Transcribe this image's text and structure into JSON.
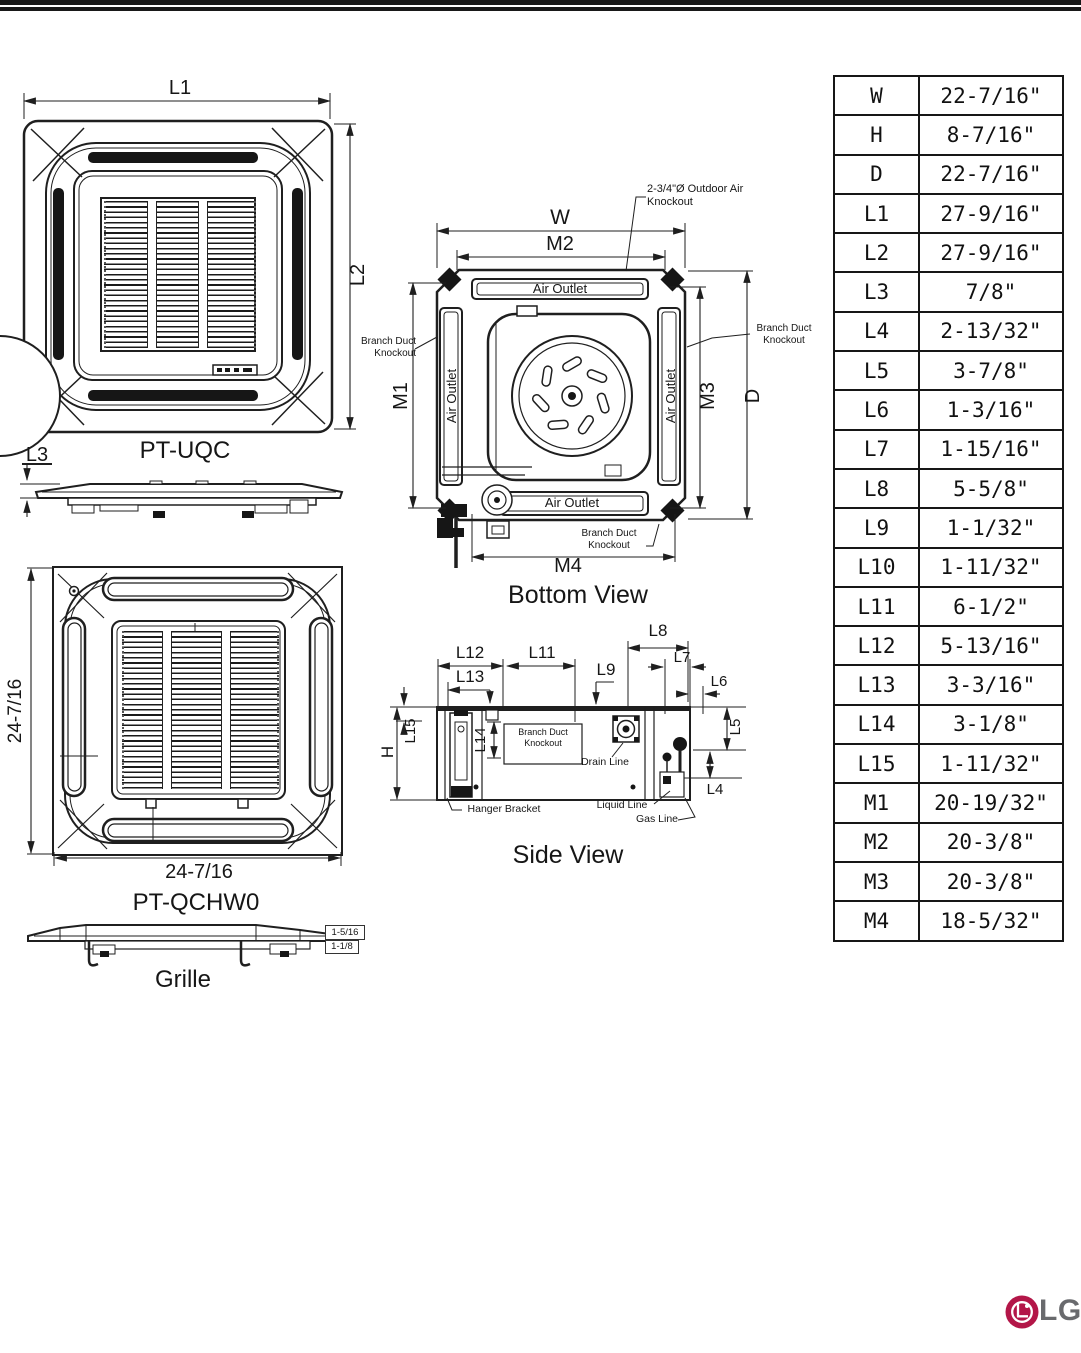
{
  "views": {
    "top": {
      "caption": "PT-UQC",
      "l1": "L1",
      "l2": "L2",
      "l3": "L3"
    },
    "bottom": {
      "title": "Bottom View",
      "w": "W",
      "m1": "M1",
      "m2": "M2",
      "m3": "M3",
      "m4": "M4",
      "d": "D",
      "air_outlet": "Air Outlet",
      "branch_duct_knockout": "Branch Duct Knockout",
      "outdoor_air_knockout": "2-3/4\"Ø Outdoor Air Knockout"
    },
    "side": {
      "title": "Side View",
      "h": "H",
      "l4": "L4",
      "l5": "L5",
      "l6": "L6",
      "l7": "L7",
      "l8": "L8",
      "l9": "L9",
      "l11": "L11",
      "l12": "L12",
      "l13": "L13",
      "l14": "L14",
      "l15": "L15",
      "branch_duct_knockout": "Branch Duct Knockout",
      "drain_line": "Drain Line",
      "hanger_bracket": "Hanger Bracket",
      "liquid_line": "Liquid Line",
      "gas_line": "Gas Line"
    },
    "grille": {
      "caption": "PT-QCHW0",
      "label": "Grille",
      "width_dim": "24-7/16",
      "height_dim": "24-7/16",
      "profile_top_dim": "1-5/16",
      "profile_bottom_dim": "1-1/8"
    }
  },
  "table": {
    "rows": [
      {
        "label": "W",
        "value": "22-7/16\""
      },
      {
        "label": "H",
        "value": "8-7/16\""
      },
      {
        "label": "D",
        "value": "22-7/16\""
      },
      {
        "label": "L1",
        "value": "27-9/16\""
      },
      {
        "label": "L2",
        "value": "27-9/16\""
      },
      {
        "label": "L3",
        "value": "7/8\""
      },
      {
        "label": "L4",
        "value": "2-13/32\""
      },
      {
        "label": "L5",
        "value": "3-7/8\""
      },
      {
        "label": "L6",
        "value": "1-3/16\""
      },
      {
        "label": "L7",
        "value": "1-15/16\""
      },
      {
        "label": "L8",
        "value": "5-5/8\""
      },
      {
        "label": "L9",
        "value": "1-1/32\""
      },
      {
        "label": "L10",
        "value": "1-11/32\""
      },
      {
        "label": "L11",
        "value": "6-1/2\""
      },
      {
        "label": "L12",
        "value": "5-13/16\""
      },
      {
        "label": "L13",
        "value": "3-3/16\""
      },
      {
        "label": "L14",
        "value": "3-1/8\""
      },
      {
        "label": "L15",
        "value": "1-11/32\""
      },
      {
        "label": "M1",
        "value": "20-19/32\""
      },
      {
        "label": "M2",
        "value": "20-3/8\""
      },
      {
        "label": "M3",
        "value": "20-3/8\""
      },
      {
        "label": "M4",
        "value": "18-5/32\""
      }
    ]
  },
  "logo": {
    "text": "LG"
  },
  "colors": {
    "line": "#1f1f1f",
    "lg_red": "#b31648",
    "lg_gray": "#696a6d"
  }
}
